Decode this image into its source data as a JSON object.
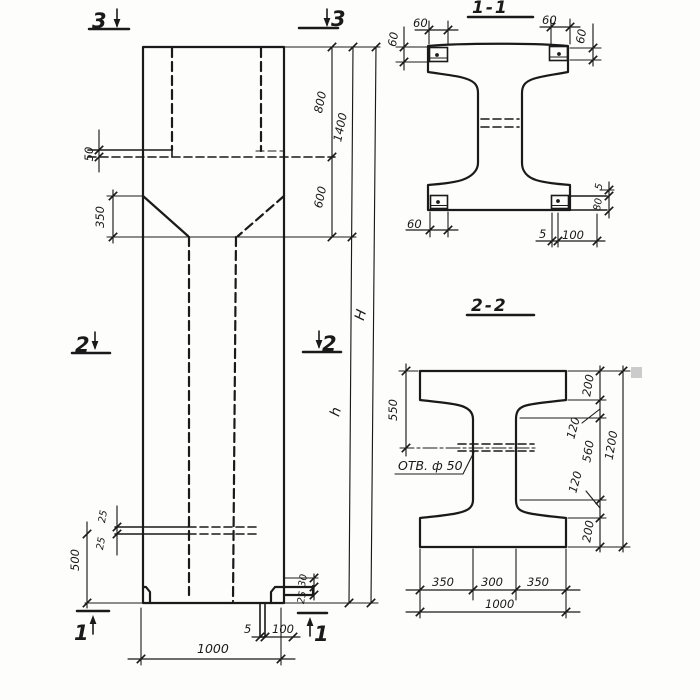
{
  "elevation": {
    "marks": {
      "m3l": "3",
      "m3r": "3",
      "m2l": "2",
      "m2r": "2",
      "m1l": "1",
      "m1r": "1"
    },
    "dims": {
      "d50": "50",
      "d350": "350",
      "d800": "800",
      "d600": "600",
      "d1400": "1400",
      "h": "h",
      "H": "H",
      "d25_top": "25",
      "d25_bot": "25",
      "d500": "500",
      "d30": "30",
      "d25_foot": "25",
      "d5": "5",
      "d100": "100",
      "d1000": "1000"
    }
  },
  "section11": {
    "title": "1-1",
    "dims": {
      "d60_tl_h": "60",
      "d60_tl_v": "60",
      "d60_tr_h": "60",
      "d60_tr_v": "60",
      "d60_bl": "60",
      "d5_h": "5",
      "d100": "100",
      "d5_v": "5",
      "d80": "80"
    }
  },
  "section22": {
    "title": "2-2",
    "hole": "ОТВ. ф 50",
    "dims": {
      "d550": "550",
      "d200_t": "200",
      "d120_t": "120",
      "d560": "560",
      "d120_b": "120",
      "d200_b": "200",
      "d1200": "1200",
      "d350_l": "350",
      "d300": "300",
      "d350_r": "350",
      "d1000": "1000"
    }
  }
}
